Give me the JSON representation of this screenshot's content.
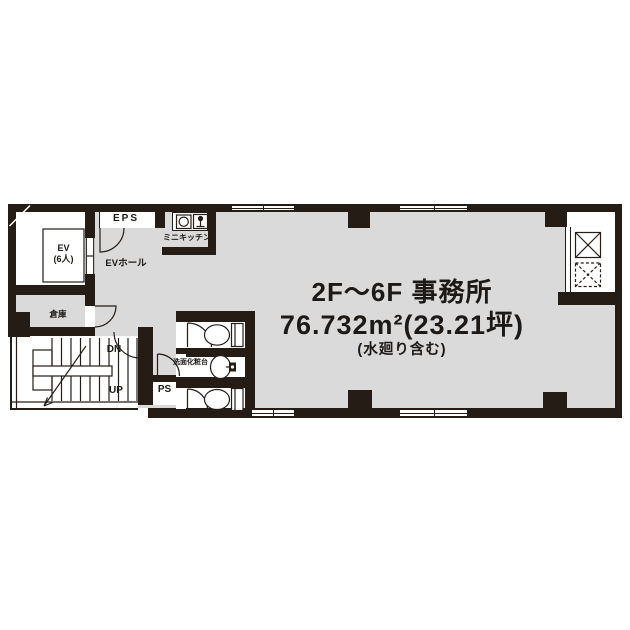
{
  "plan": {
    "unit_title": "2F〜6F 事務所",
    "unit_area": "76.732m²(23.21坪)",
    "unit_note": "(水廻り含む)",
    "labels": {
      "eps": "EPS",
      "mini_kitchen": "ミニキッチン",
      "ev_line1": "EV",
      "ev_line2": "(6人)",
      "ev_hall": "EVホール",
      "storage": "倉庫",
      "dn": "DN",
      "up": "UP",
      "ps": "PS",
      "vanity": "洗面化粧台"
    },
    "colors": {
      "wall": "#261c16",
      "floor": "#dadada",
      "text": "#1d1916"
    },
    "icons": {
      "toilet-icon": "bowl ellipse + tank rectangle",
      "washbasin-icon": "oval basin + faucet block",
      "sink-icon": "square with circle burner",
      "faucet-icon": "tap with stem",
      "shaft-duct-solid-icon": "solid box with X",
      "shaft-duct-dashed-icon": "dashed box with X",
      "stairs-icon": "treads with up arrow",
      "door-swing-icon": "quarter-circle arc",
      "window-icon": "double-line gap in wall",
      "elevator-icon": "car rectangle with door gap"
    }
  }
}
